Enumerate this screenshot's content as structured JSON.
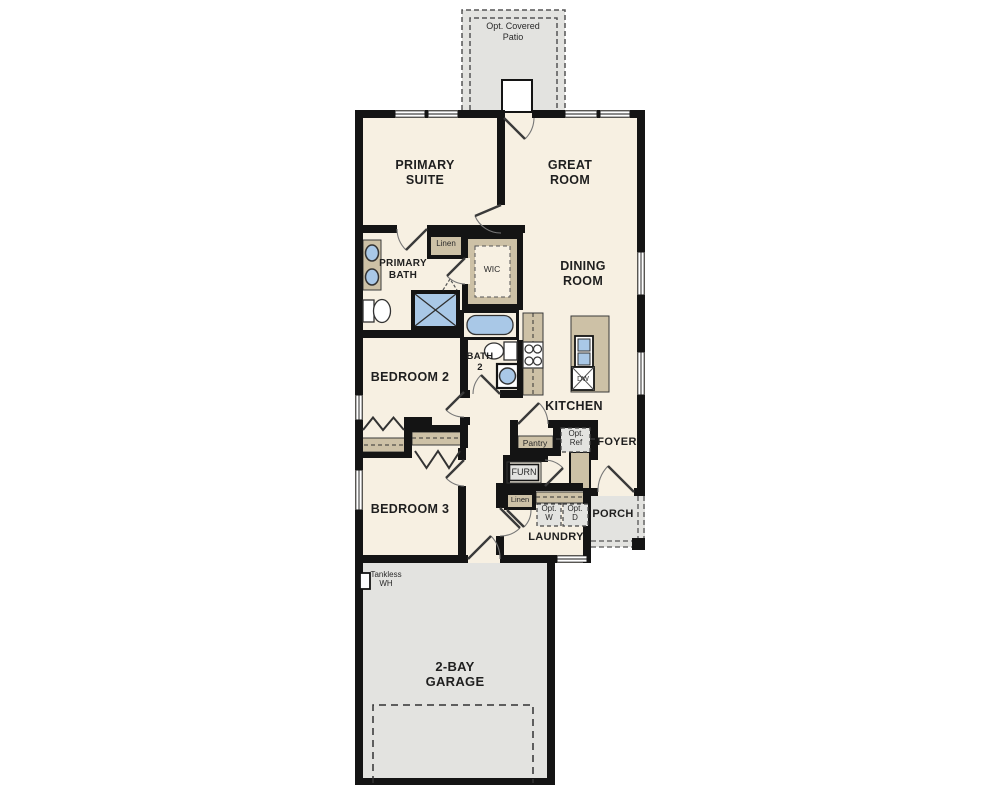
{
  "plan_title": "single-story floor plan",
  "colors": {
    "wall": "#141414",
    "floor_cream": "#f7f0e2",
    "cabinet_tan": "#cdc1a6",
    "fixture_blue": "#a9c8e7",
    "concrete_gray": "#e3e3e0",
    "label_dark": "#1f1f1f"
  },
  "plan": {
    "patio": "Opt. Covered Patio",
    "primary_suite": "PRIMARY SUITE",
    "great_room": "GREAT ROOM",
    "primary_bath": "PRIMARY BATH",
    "linen_1": "Linen",
    "wic": "WIC",
    "dining_room": "DINING ROOM",
    "bedroom_2": "BEDROOM 2",
    "bath_2": "BATH 2",
    "kitchen": "KITCHEN",
    "dishwasher": "DW",
    "pantry": "Pantry",
    "opt_ref": "Opt. Ref",
    "foyer": "FOYER",
    "furnace": "FURN",
    "linen_2": "Linen",
    "opt_washer": "Opt. W",
    "opt_dryer": "Opt. D",
    "porch": "PORCH",
    "laundry": "LAUNDRY",
    "bedroom_3": "BEDROOM 3",
    "tankless_wh": "Tankless WH",
    "garage": "2-BAY GARAGE"
  }
}
